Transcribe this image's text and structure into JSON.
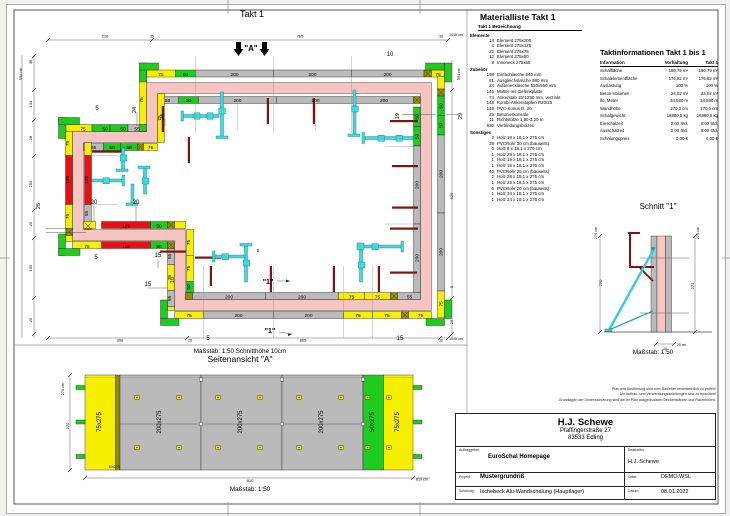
{
  "sheet": {
    "plan_title": "Takt 1",
    "scale_note": "Maßstab: 1:50   Schnitthöhe 10cm",
    "side_title": "Seitenansicht \"A\"",
    "side_scale": "Maßstab: 1:50",
    "schnitt_title": "Schnitt \"1\"",
    "schnitt_scale": "Maßstab: 1:50"
  },
  "colors": {
    "wall_pink": "#f6c5c2",
    "panel_gray": "#bababa",
    "panel_yellow": "#f6ef00",
    "panel_green": "#1ecb1e",
    "panel_red": "#e81010",
    "brace_cyan": "#3fd9df",
    "board_darkred": "#7b150f"
  },
  "material": {
    "title": "Materialliste  Takt 1",
    "header": "Takt 1  Bezeichnung",
    "sections": [
      {
        "label": "Elemente",
        "rows": [
          [
            "14",
            "Element 275x200"
          ],
          [
            "4",
            "Element 275x125"
          ],
          [
            "22",
            "Element 275x75"
          ],
          [
            "12",
            "Element 275x50"
          ],
          [
            "8",
            "Inneneck 275x55"
          ]
        ]
      },
      {
        "label": "Zubehör",
        "rows": [
          [
            "198",
            "Einfachlasche 540 mm"
          ],
          [
            "81",
            "Ausgleichslasche 880 mm"
          ],
          [
            "24",
            "Außenecklasche 550x550 mm"
          ],
          [
            "146",
            "Mutter mit Gelenkplatte"
          ],
          [
            "74",
            "Ankerstab 15*1250 mm, verzinkt"
          ],
          [
            "148",
            "Kombi-Ankerstopfen R20/25"
          ],
          [
            "148",
            "PVC-Konus D. 20"
          ],
          [
            "25",
            "Betonierkonsole"
          ],
          [
            "11",
            "Richtstütze 1,80-3,20 m"
          ],
          [
            "630",
            "Verbindungsbolzen"
          ]
        ]
      },
      {
        "label": "Sonstiges",
        "rows": [
          [
            "2",
            "Holz 18 x 18,1 x 275 cm"
          ],
          [
            "29",
            "PVCRohr 30 cm (bauseits)"
          ],
          [
            "6",
            "Holz 8 x 18,1 x 270 cm"
          ],
          [
            "1",
            "Holz 29 x 18,1 x 275 cm"
          ],
          [
            "1",
            "Holz 19 x 18,1 x 275 cm"
          ],
          [
            "1",
            "Holz 15 x 18,1 x 275 cm"
          ],
          [
            "40",
            "PVCRohr 25 cm (bauseits)"
          ],
          [
            "2",
            "Holz 28 x 18,1 x 275 cm"
          ],
          [
            "1",
            "Holz 25 x 18,1 x 275 cm"
          ],
          [
            "6",
            "PVCRohr 20 cm (bauseits)"
          ],
          [
            "1",
            "Holz 34 x 18,1 x 275 cm"
          ],
          [
            "1",
            "Holz 24 x 18,1 x 275 cm"
          ]
        ]
      }
    ]
  },
  "taktinfo": {
    "title": "Taktinformationen  Takt 1 bis 1",
    "columns": [
      "Information",
      "Vorhaltung",
      "Takt 1"
    ],
    "rows": [
      [
        "Schalfläche",
        "180,79 m²",
        "180,79 m²"
      ],
      [
        "Schalelementfläche",
        "176,82 m²",
        "176,82 m²"
      ],
      [
        "Auslastung",
        "100 %",
        "100 %"
      ],
      [
        "Beton-Volumen",
        "24,02 m³",
        "24,02 m³"
      ],
      [
        "lfd. Meter",
        "34,580 m",
        "34,580 m"
      ],
      [
        "Wandhöhe",
        "270,0 cm",
        "270,0 cm"
      ],
      [
        "Schalgewicht",
        "16880,5 kg",
        "16880,5 kg"
      ],
      [
        "Einschalzeit",
        "0:00 Std.",
        "0:00 Std."
      ],
      [
        "Ausschalzeit",
        "0:00 Std.",
        "0:00 Std."
      ],
      [
        "Schalungspreis",
        "0,00 €",
        "0,00 €"
      ]
    ]
  },
  "disclaimer": [
    "Plan und Ausführung sind vom Bauleiter verantwortlich zu prüfen!",
    "Die Aufbau- und Verwendungsanleitungen sind zu beachten!",
    "Grundlagen der Dimensionierung sind die im Plan ausgedruckten Deckenstärken und Raumhöhen."
  ],
  "titleblock": {
    "company": "H.J. Schewe",
    "street": "Pfaffingerstraße 27",
    "city": "83533 Edling",
    "fields": [
      {
        "label": "Auftraggeber:",
        "value": "EuroSchal Homepage"
      },
      {
        "label": "Bearbeiter",
        "value": "H.J. Schewe"
      },
      {
        "label": "Projekt:",
        "value": "Mustergrundriß"
      },
      {
        "label": "Datei:",
        "value": "DEMO.WSL"
      },
      {
        "label": "Schalung:",
        "value": "Ischebeck Alu-Wandschalung (Hauptlager)"
      },
      {
        "label": "Datum:",
        "value": "08.01.2022"
      }
    ]
  },
  "plan_labels": [
    {
      "t": "75",
      "x": 161,
      "y": 75.8
    },
    {
      "t": "50",
      "x": 185.5,
      "y": 75.8
    },
    {
      "t": "200",
      "x": 234.5,
      "y": 75.8
    },
    {
      "t": "200",
      "x": 312.5,
      "y": 75.8
    },
    {
      "t": "200",
      "x": 387.5,
      "y": 75.8
    },
    {
      "t": "75",
      "x": 438,
      "y": 75.8
    },
    {
      "t": "55",
      "x": 167.5,
      "y": 102.2
    },
    {
      "t": "50",
      "x": 188.5,
      "y": 102.2
    },
    {
      "t": "200",
      "x": 237.5,
      "y": 102.2
    },
    {
      "t": "200",
      "x": 315.5,
      "y": 102.2
    },
    {
      "t": "200",
      "x": 384,
      "y": 102.2
    },
    {
      "t": "50",
      "x": 442.5,
      "y": 106,
      "r": -90
    },
    {
      "t": "50",
      "x": 442.5,
      "y": 125.5,
      "r": -90
    },
    {
      "t": "200",
      "x": 442.5,
      "y": 174,
      "r": -90
    },
    {
      "t": "200",
      "x": 442.5,
      "y": 252,
      "r": -90
    },
    {
      "t": "75",
      "x": 442.5,
      "y": 304,
      "r": -90
    },
    {
      "t": "50",
      "x": 418.5,
      "y": 117,
      "r": -90
    },
    {
      "t": "50",
      "x": 418.5,
      "y": 136.5,
      "r": -90
    },
    {
      "t": "200",
      "x": 418.5,
      "y": 185,
      "r": -90
    },
    {
      "t": "200",
      "x": 418.5,
      "y": 258,
      "r": -90
    },
    {
      "t": "75",
      "x": 189,
      "y": 317
    },
    {
      "t": "200",
      "x": 238.5,
      "y": 317
    },
    {
      "t": "200",
      "x": 308.5,
      "y": 317
    },
    {
      "t": "75",
      "x": 358,
      "y": 317
    },
    {
      "t": "75",
      "x": 387,
      "y": 317
    },
    {
      "t": "75",
      "x": 420.5,
      "y": 317
    },
    {
      "t": "200",
      "x": 229,
      "y": 298.3
    },
    {
      "t": "200",
      "x": 302,
      "y": 298.3
    },
    {
      "t": "75",
      "x": 351.5,
      "y": 298.3
    },
    {
      "t": "75",
      "x": 377.5,
      "y": 298.3
    },
    {
      "t": "55",
      "x": 409.5,
      "y": 298.3
    },
    {
      "t": "75",
      "x": 83,
      "y": 130.3
    },
    {
      "t": "50",
      "x": 105,
      "y": 130.3
    },
    {
      "t": "50",
      "x": 123,
      "y": 130.3
    },
    {
      "t": "55",
      "x": 137,
      "y": 130.3
    },
    {
      "t": "55",
      "x": 93.5,
      "y": 149
    },
    {
      "t": "50",
      "x": 112,
      "y": 149
    },
    {
      "t": "50",
      "x": 129,
      "y": 149
    },
    {
      "t": "75",
      "x": 150.5,
      "y": 149
    },
    {
      "t": "75",
      "x": 69.2,
      "y": 143.5,
      "r": -90
    },
    {
      "t": "125",
      "x": 69.2,
      "y": 180,
      "r": -90
    },
    {
      "t": "75",
      "x": 69.2,
      "y": 216.5,
      "r": -90
    },
    {
      "t": "125",
      "x": 88.2,
      "y": 180,
      "r": -90
    },
    {
      "t": "55",
      "x": 88.2,
      "y": 213.5,
      "r": -90
    },
    {
      "t": "75",
      "x": 143,
      "y": 100,
      "r": -90
    },
    {
      "t": "75",
      "x": 161,
      "y": 118,
      "r": -90
    },
    {
      "t": "75",
      "x": 87,
      "y": 247.8
    },
    {
      "t": "125",
      "x": 126,
      "y": 247.8
    },
    {
      "t": "50",
      "x": 159,
      "y": 247.8
    },
    {
      "t": "125",
      "x": 126,
      "y": 227.6
    },
    {
      "t": "50",
      "x": 159,
      "y": 227.6
    },
    {
      "t": "55",
      "x": 171.2,
      "y": 256.5,
      "r": -90
    },
    {
      "t": "75",
      "x": 171.2,
      "y": 277.5,
      "r": -90
    },
    {
      "t": "55",
      "x": 171.2,
      "y": 298.5,
      "r": -90
    },
    {
      "t": "75",
      "x": 190.2,
      "y": 242.5,
      "r": -90
    },
    {
      "t": "75",
      "x": 190.2,
      "y": 268.5,
      "r": -90
    },
    {
      "t": "50",
      "x": 190.2,
      "y": 287,
      "r": -90
    },
    {
      "t": "216",
      "x": 105,
      "y": 37.6,
      "s": 4
    },
    {
      "t": "35",
      "x": 152,
      "y": 37.6,
      "s": 3.4
    },
    {
      "t": "765",
      "x": 300,
      "y": 37.6,
      "s": 4
    },
    {
      "t": "30",
      "x": 441,
      "y": 37.6,
      "s": 3.4
    },
    {
      "t": "1045 cm",
      "x": 449,
      "y": 36,
      "s": 3.6,
      "a": "start"
    },
    {
      "t": "594 cm",
      "x": 22,
      "y": 74,
      "r": -90,
      "s": 3.8
    },
    {
      "t": "36",
      "x": 32,
      "y": 62,
      "r": -90,
      "s": 3.8
    },
    {
      "t": "134",
      "x": 32,
      "y": 104,
      "r": -90,
      "s": 4
    },
    {
      "t": "28",
      "x": 32,
      "y": 138,
      "r": -90,
      "s": 3.8
    },
    {
      "t": "255",
      "x": 32,
      "y": 184,
      "r": -90,
      "s": 4
    },
    {
      "t": "20",
      "x": 32,
      "y": 224,
      "r": -90,
      "s": 3.8
    },
    {
      "t": "195",
      "x": 32,
      "y": 268,
      "r": -90,
      "s": 4
    },
    {
      "t": "20",
      "x": 32,
      "y": 320,
      "r": -90,
      "s": 3.8
    },
    {
      "t": "594 cm",
      "x": 460,
      "y": 74,
      "r": -90,
      "s": 3.8
    },
    {
      "t": "629",
      "x": 453,
      "y": 196,
      "r": -90,
      "s": 4
    },
    {
      "t": "5",
      "x": 453,
      "y": 287,
      "r": -90,
      "s": 3.8
    },
    {
      "t": "20",
      "x": 453,
      "y": 322,
      "r": -90,
      "s": 3.8
    },
    {
      "t": "308",
      "x": 120,
      "y": 341.4,
      "s": 4
    },
    {
      "t": "28",
      "x": 190,
      "y": 341.4,
      "s": 3.4
    },
    {
      "t": "865",
      "x": 303,
      "y": 341.4,
      "s": 4
    },
    {
      "t": "30",
      "x": 441,
      "y": 341.4,
      "s": 3.4
    },
    {
      "t": "1045 cm",
      "x": 449,
      "y": 340,
      "s": 3.6,
      "a": "start"
    },
    {
      "t": "10",
      "x": 390,
      "y": 56,
      "s": 6
    },
    {
      "t": "24",
      "x": 136,
      "y": 110,
      "r": -90,
      "s": 5.5
    },
    {
      "t": "24",
      "x": 164,
      "y": 117,
      "r": -90,
      "s": 5.5
    },
    {
      "t": "5",
      "x": 97,
      "y": 110,
      "s": 6
    },
    {
      "t": "19",
      "x": 399,
      "y": 116,
      "r": -90,
      "s": 5.5
    },
    {
      "t": "29",
      "x": 462,
      "y": 116,
      "r": -90,
      "s": 5.5
    },
    {
      "t": "25",
      "x": 40,
      "y": 206,
      "r": -90,
      "s": 5.5
    },
    {
      "t": "20",
      "x": 94,
      "y": 204,
      "s": 6
    },
    {
      "t": "20",
      "x": 136,
      "y": 204,
      "s": 6
    },
    {
      "t": "5",
      "x": 96,
      "y": 259,
      "s": 6
    },
    {
      "t": "15",
      "x": 158,
      "y": 257,
      "s": 6
    },
    {
      "t": "10",
      "x": 174,
      "y": 280,
      "r": -90,
      "s": 5.5
    },
    {
      "t": "15",
      "x": 148,
      "y": 286,
      "s": 6
    },
    {
      "t": "5",
      "x": 258,
      "y": 252,
      "s": 4.5
    },
    {
      "t": "5",
      "x": 208,
      "y": 340,
      "s": 6
    },
    {
      "t": "15",
      "x": 400,
      "y": 340,
      "s": 6
    },
    {
      "t": "\"1\"",
      "x": 268,
      "y": 284,
      "s": 7,
      "w": "bold"
    },
    {
      "t": "\"1\"",
      "x": 270,
      "y": 333,
      "s": 7,
      "w": "bold"
    },
    {
      "t": "\"A\"",
      "x": 251,
      "y": 51,
      "s": 8,
      "w": "bold"
    }
  ],
  "side_labels": [
    {
      "t": "75x275",
      "x": 101,
      "y": 422,
      "r": -90,
      "s": 6
    },
    {
      "t": "200x275",
      "x": 161,
      "y": 422,
      "r": -90,
      "s": 6
    },
    {
      "t": "200x275",
      "x": 242,
      "y": 422,
      "r": -90,
      "s": 6
    },
    {
      "t": "200x275",
      "x": 323,
      "y": 422,
      "r": -90,
      "s": 6
    },
    {
      "t": "50x275",
      "x": 374,
      "y": 422,
      "r": -90,
      "s": 6
    },
    {
      "t": "75x275",
      "x": 399,
      "y": 422,
      "r": -90,
      "s": 6
    },
    {
      "t": "10x270",
      "x": 114,
      "y": 468,
      "s": 3.4
    },
    {
      "t": "270 cm",
      "x": 64,
      "y": 389,
      "r": -90,
      "s": 3.8
    },
    {
      "t": "270",
      "x": 69,
      "y": 426,
      "r": -90,
      "s": 4
    },
    {
      "t": "810",
      "x": 250,
      "y": 482,
      "s": 4
    },
    {
      "t": "810 cm",
      "x": 416,
      "y": 480.5,
      "s": 3.6,
      "a": "start"
    }
  ],
  "schnitt_labels": [
    {
      "t": "270 cm",
      "x": 597,
      "y": 233,
      "r": -90,
      "s": 3.8
    },
    {
      "t": "270",
      "x": 602,
      "y": 283,
      "r": -90,
      "s": 4
    },
    {
      "t": "275 cm",
      "x": 699,
      "y": 233,
      "r": -90,
      "s": 3.8
    },
    {
      "t": "275",
      "x": 694,
      "y": 286,
      "r": -90,
      "s": 4
    },
    {
      "t": "25 cm",
      "x": 677,
      "y": 346,
      "s": 3.4,
      "a": "start"
    },
    {
      "t": "25",
      "x": 665,
      "y": 350,
      "s": 3.2
    }
  ]
}
